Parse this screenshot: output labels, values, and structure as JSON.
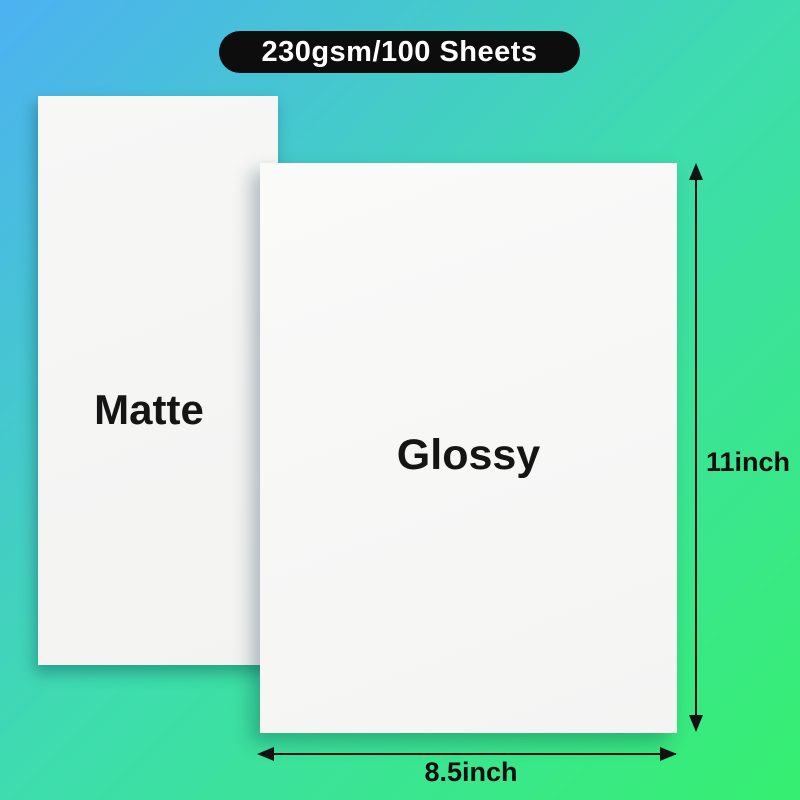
{
  "badge": {
    "label": "230gsm/100 Sheets"
  },
  "papers": [
    {
      "label": "Matte"
    },
    {
      "label": "Glossy"
    }
  ],
  "dimensions": {
    "height_label": "11inch",
    "width_label": "8.5inch"
  },
  "colors": {
    "background_gradient_start": "#4db1f2",
    "background_gradient_mid": "#3edcae",
    "background_gradient_end": "#36ef70",
    "badge_background": "#0d0d0d",
    "badge_text": "#ffffff",
    "paper": "#f6f6f5",
    "label_text": "#151515",
    "arrow": "#121212"
  }
}
